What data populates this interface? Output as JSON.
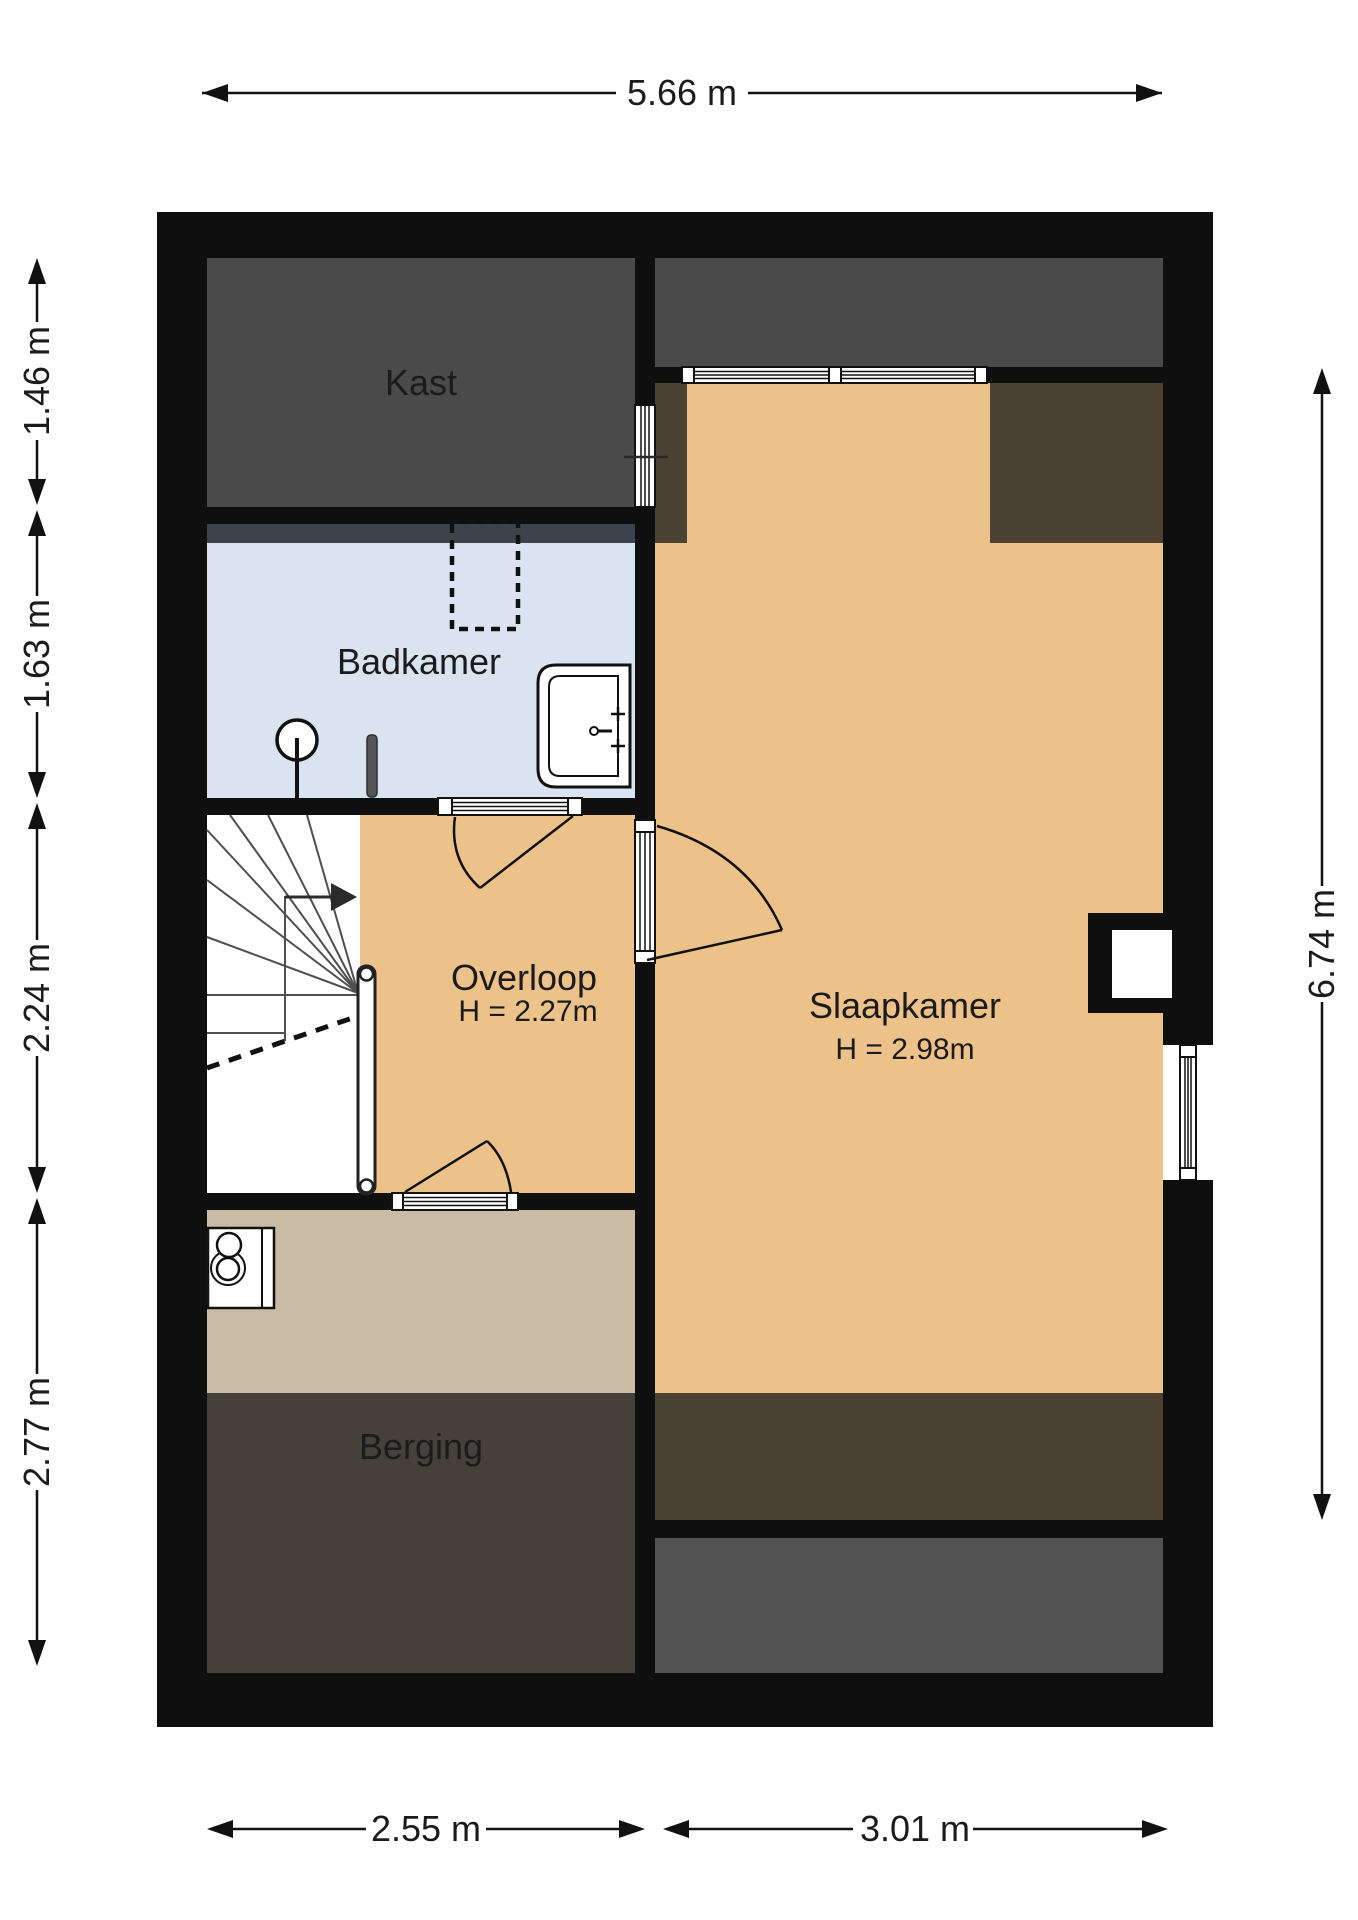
{
  "title": "Verdieping plattegrond (floor plan)",
  "rooms": {
    "kast": {
      "label": "Kast"
    },
    "badkamer": {
      "label": "Badkamer"
    },
    "overloop": {
      "label": "Overloop",
      "height": "H = 2.27m"
    },
    "slaapkamer": {
      "label": "Slaapkamer",
      "height": "H = 2.98m"
    },
    "berging": {
      "label": "Berging"
    }
  },
  "dimensions": {
    "top": "5.66 m",
    "left": [
      "1.46 m",
      "1.63 m",
      "2.24 m",
      "2.77 m"
    ],
    "right": "6.74 m",
    "bottom": [
      "2.55 m",
      "3.01 m"
    ]
  },
  "icons": [
    "stairs-icon",
    "stairs-direction-arrow-icon",
    "handrail-icon",
    "walkline-dashed-icon",
    "sink-icon",
    "ceiling-light-icon",
    "radiator-pin-icon",
    "boiler-icon",
    "skylight-dashed-icon",
    "window-icon",
    "door-swing-icon",
    "chimney-niche-icon"
  ],
  "palette": {
    "wall": "#0f0f0f",
    "room_dark_gray": "#4a4a4a",
    "room_tan": "#ecc28a",
    "room_blue": "#d9e4f0",
    "room_beige": "#c9bba4",
    "strip_brown": "#4b4234",
    "berging_dark": "#45413a",
    "bottom_gray": "#525252",
    "shadow_strip": "#3d434c",
    "dimension_line": "#111111"
  }
}
